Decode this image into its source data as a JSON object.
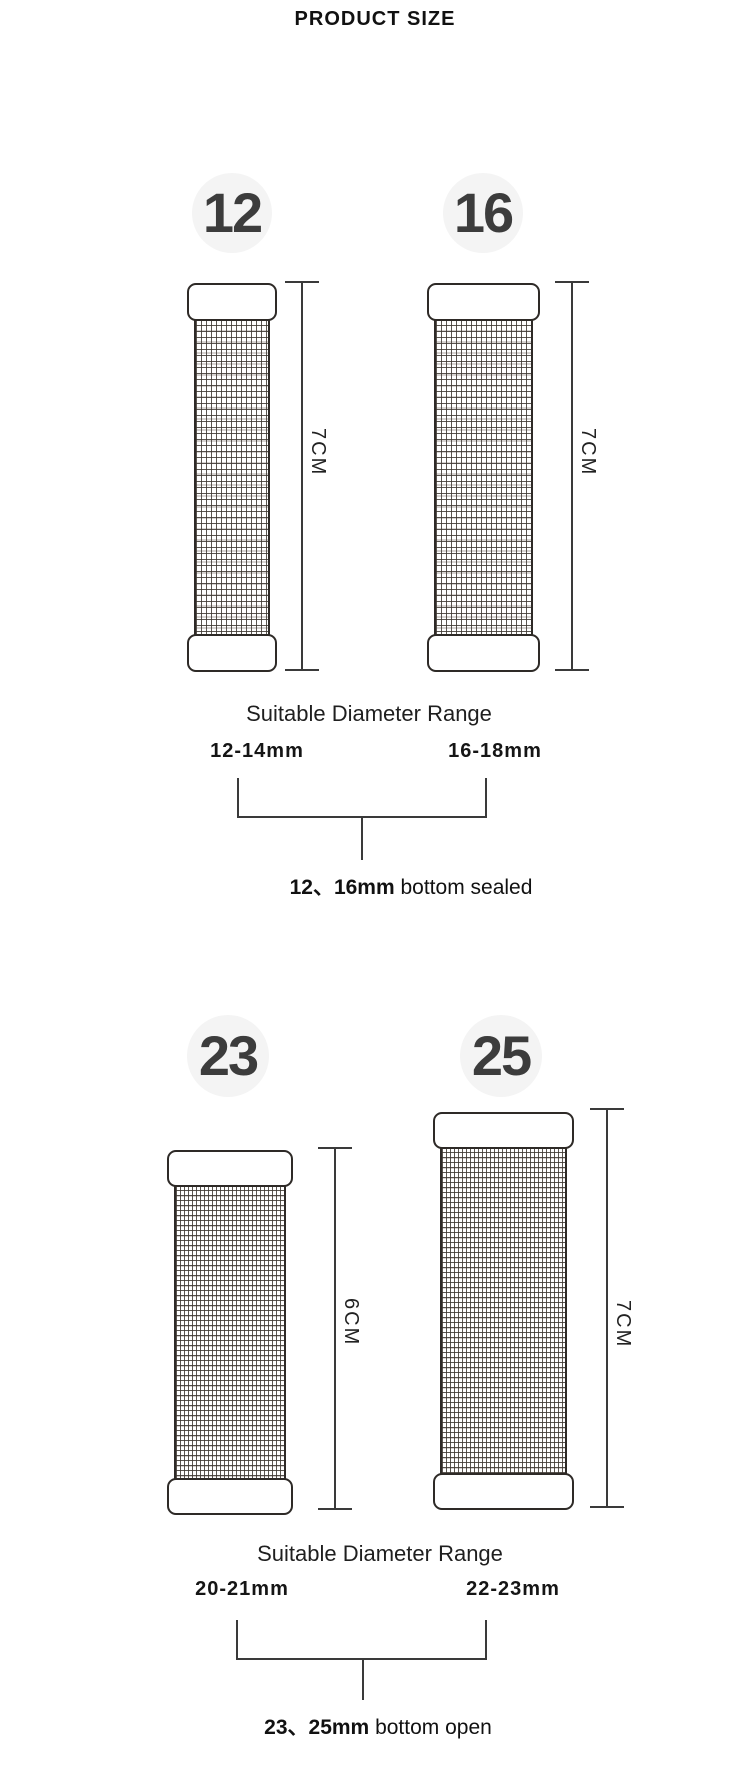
{
  "title": "PRODUCT SIZE",
  "colors": {
    "outline": "#2e2a27",
    "line": "#3a3a3a",
    "text": "#1c1c1c",
    "badge_bg": "#f4f4f4",
    "badge_text": "#3c3c3c"
  },
  "sections": [
    {
      "badges": [
        "12",
        "16"
      ],
      "dim_labels": [
        "7CM",
        "7CM"
      ],
      "range_title": "Suitable Diameter Range",
      "ranges": [
        "12-14mm",
        "16-18mm"
      ],
      "note_bold": "12、16mm",
      "note_rest": " bottom sealed"
    },
    {
      "badges": [
        "23",
        "25"
      ],
      "dim_labels": [
        "6CM",
        "7CM"
      ],
      "range_title": "Suitable Diameter Range",
      "ranges": [
        "20-21mm",
        "22-23mm"
      ],
      "note_bold": "23、25mm",
      "note_rest": " bottom open"
    }
  ]
}
